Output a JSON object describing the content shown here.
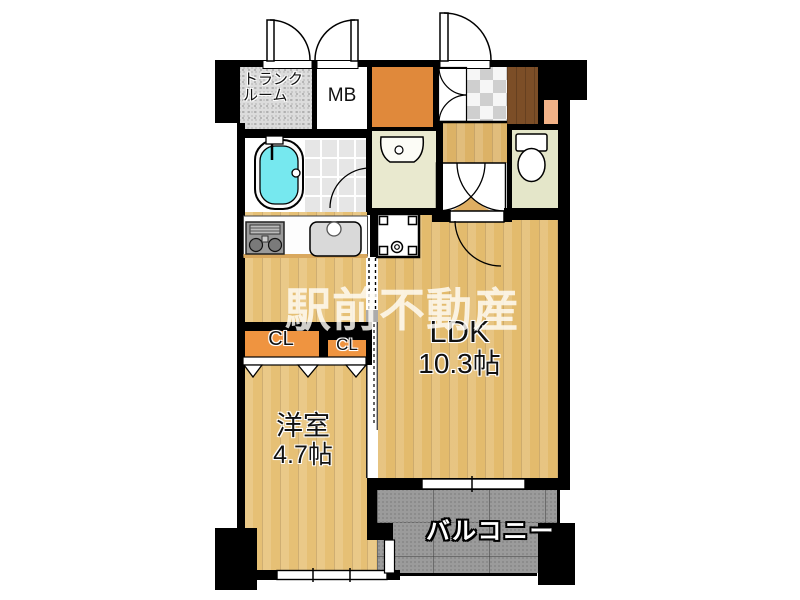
{
  "plan": {
    "labels": {
      "trunk_room": "トランク\nルーム",
      "meter_box": "MB",
      "ldk_name": "LDK",
      "ldk_size": "10.3帖",
      "western_room_name": "洋室",
      "western_room_size": "4.7帖",
      "closet1": "CL",
      "closet2": "CL",
      "balcony": "バルコニー",
      "watermark": "駅前不動産"
    },
    "colors": {
      "wall": "#000000",
      "wood_floor": "#e6c075",
      "ldk_floor": "#e3bb6d",
      "orange_room": "#e0893b",
      "closet_fill": "#ef9440",
      "washroom_floor": "#e9e9cf",
      "toilet_floor": "#e4e6c9",
      "balcony_floor": "#9b9b9b",
      "entry_step": "#7c4e27",
      "shelf_peach": "#f2b287",
      "bathtub_water": "#76e8ef",
      "watermark_text": "#fffdf6"
    },
    "icons": {
      "bathtub-icon": "svg-rounded-tub",
      "washbasin-icon": "svg-basin",
      "toilet-icon": "svg-tank-and-bowl",
      "gas-stove-icon": "svg-two-burners",
      "kitchen-sink-icon": "svg-sink",
      "washer-pan-icon": "svg-square-pan",
      "door-swing-icon": "quarter-arc",
      "folding-door-icon": "triangle-zigzag",
      "window-icon": "white-bar-with-ticks"
    }
  }
}
